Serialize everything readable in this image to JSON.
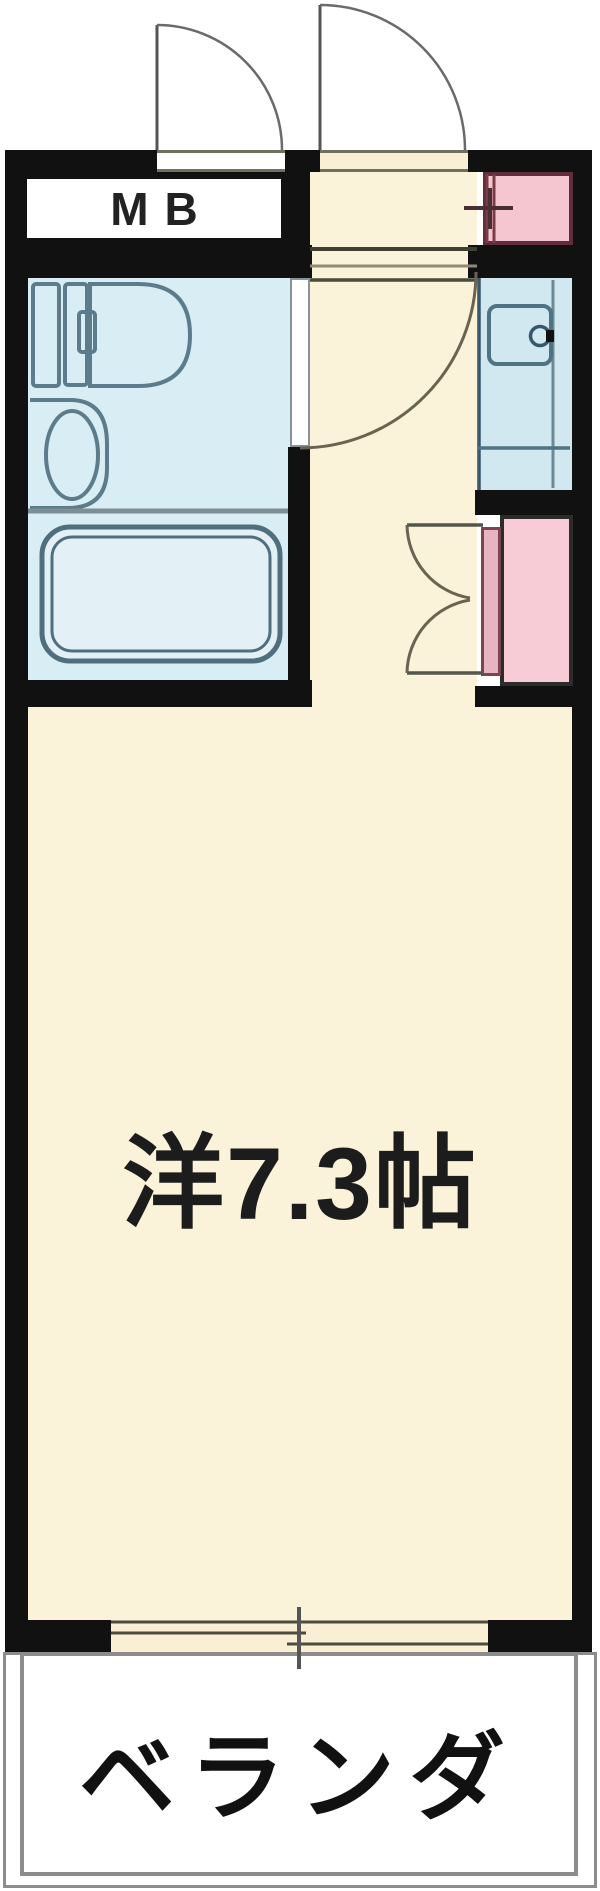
{
  "floor_plan": {
    "meter_box_label": "MB",
    "main_room_label": "洋7.3帖",
    "balcony_label": "ベランダ",
    "rooms": [
      {
        "name": "meter-box",
        "label": "MB"
      },
      {
        "name": "entrance-hallway",
        "label": ""
      },
      {
        "name": "bathroom-unit",
        "label": ""
      },
      {
        "name": "kitchen-counter",
        "label": ""
      },
      {
        "name": "closet",
        "label": ""
      },
      {
        "name": "pipe-space",
        "label": ""
      },
      {
        "name": "main-room",
        "label": "洋7.3帖"
      },
      {
        "name": "balcony",
        "label": "ベランダ"
      }
    ],
    "features": [
      "meter-box-door-swing",
      "entrance-door-swing",
      "bathroom-door-swing",
      "toilet",
      "wash-basin",
      "bathtub",
      "kitchen-sink",
      "faucet",
      "closet-double-door",
      "genkan-step-lines",
      "sliding-window"
    ],
    "colors": {
      "wall": "#111111",
      "floor_cream": "#faf2d9",
      "wet_area_blue": "#d9edf4",
      "kitchen_blue": "#d2e8f1",
      "closet_pink": "#f8ccd6",
      "pipe_space_pink": "#f6c6d0",
      "fixture_stroke": "#5c7c8c",
      "door_arc": "#6b6250",
      "balcony_border": "#8c8c8c"
    }
  }
}
